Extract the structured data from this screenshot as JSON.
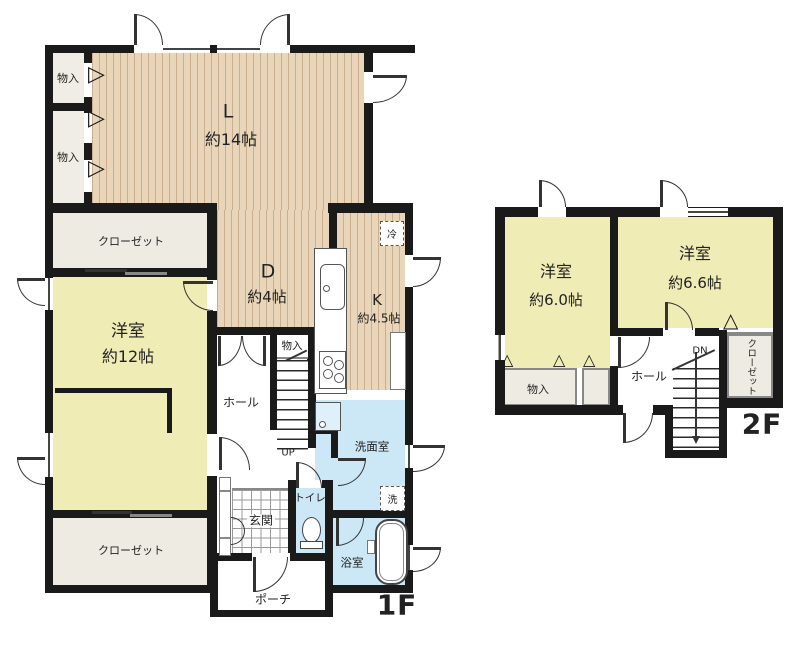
{
  "floor1": {
    "label": "1F",
    "living": {
      "abbr": "L",
      "size": "約14帖"
    },
    "dining": {
      "abbr": "D",
      "size": "約4帖"
    },
    "kitchen": {
      "abbr": "K",
      "size": "約4.5帖"
    },
    "western_room": {
      "name": "洋室",
      "size": "約12帖"
    },
    "closet_upper": "クローゼット",
    "closet_lower": "クローゼット",
    "storage_upper": "物入",
    "storage_lower": "物入",
    "stair_storage": "物入",
    "hall": "ホール",
    "entrance": "玄関",
    "porch": "ポーチ",
    "toilet": "トイレ",
    "washroom": "洗面室",
    "bathroom": "浴室",
    "stairs_up": "UP",
    "refrigerator": "冷",
    "washing_machine": "洗"
  },
  "floor2": {
    "label": "2F",
    "western_room_left": {
      "name": "洋室",
      "size": "約6.0帖"
    },
    "western_room_right": {
      "name": "洋室",
      "size": "約6.6帖"
    },
    "storage": "物入",
    "hall": "ホール",
    "closet": "クローゼット",
    "stairs_down": "DN"
  },
  "door_marks": {
    "right": "▷",
    "up": "△"
  },
  "colors": {
    "wall": "#1a1a1a",
    "wood_floor": "#e9d6ba",
    "room_yellow": "#f0ecb5",
    "wet_blue": "#cce7f5",
    "closet_floor": "#eeebe3"
  }
}
